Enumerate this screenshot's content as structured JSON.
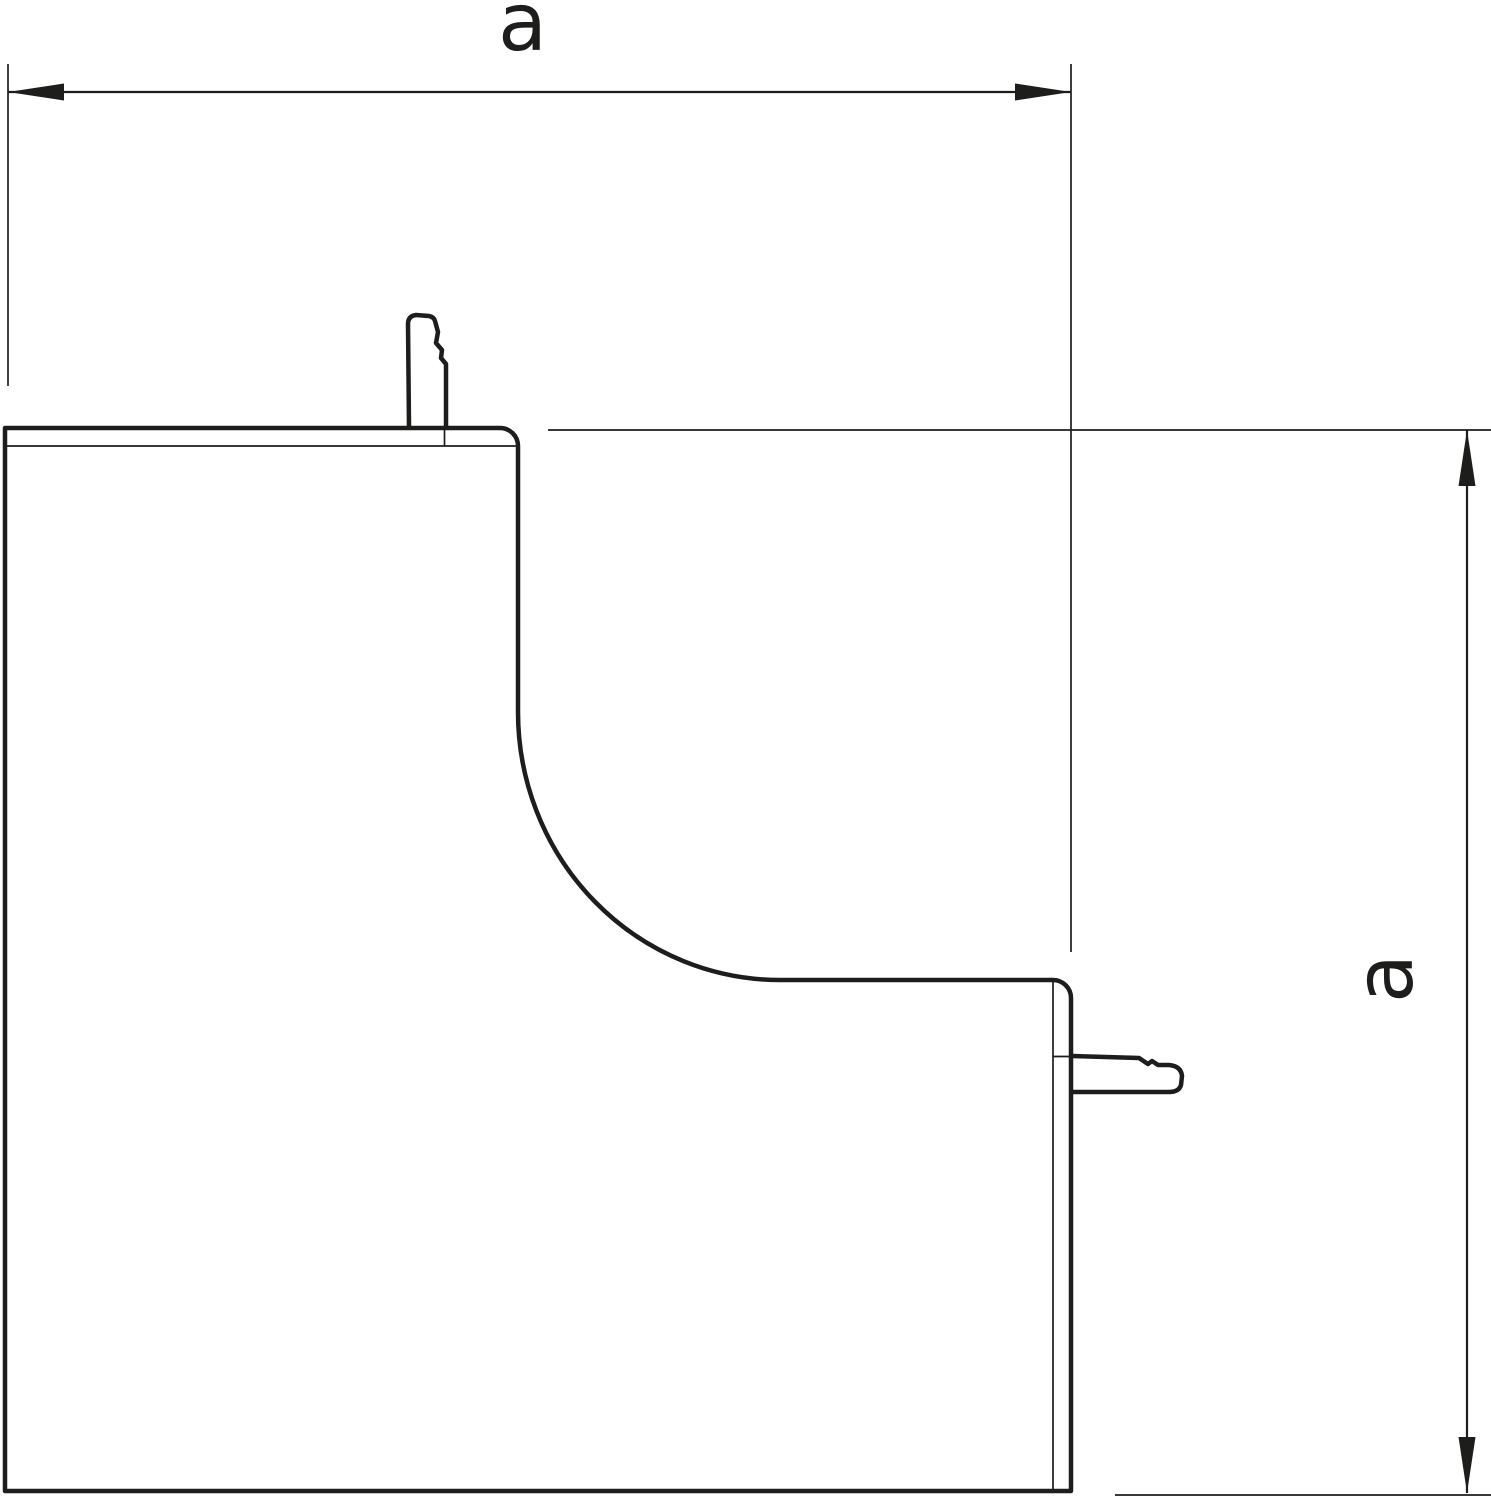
{
  "page": {
    "background": "#ffffff"
  },
  "colors": {
    "line": "#1d1d1b",
    "background": "#ffffff"
  },
  "drawing": {
    "kind": "technical-dimension-drawing",
    "part": "internal-corner-cover-profile",
    "dimensions": {
      "width": {
        "label": "a"
      },
      "height": {
        "label": "a"
      }
    }
  }
}
